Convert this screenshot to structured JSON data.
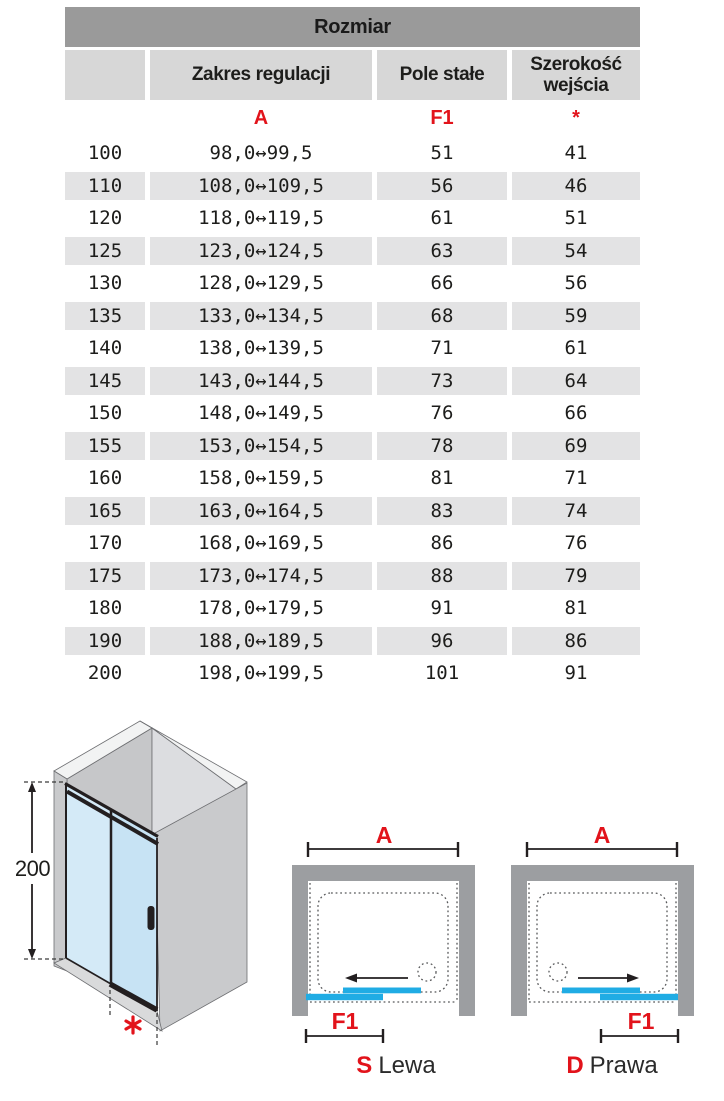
{
  "table": {
    "title": "Rozmiar",
    "columns": [
      "",
      "Zakres regulacji",
      "Pole stałe",
      "Szerokość wejścia"
    ],
    "symbols": [
      "",
      "A",
      "F1",
      "*"
    ],
    "rows": [
      {
        "size": "100",
        "range": "98,0↔99,5",
        "fixed": "51",
        "entry": "41"
      },
      {
        "size": "110",
        "range": "108,0↔109,5",
        "fixed": "56",
        "entry": "46"
      },
      {
        "size": "120",
        "range": "118,0↔119,5",
        "fixed": "61",
        "entry": "51"
      },
      {
        "size": "125",
        "range": "123,0↔124,5",
        "fixed": "63",
        "entry": "54"
      },
      {
        "size": "130",
        "range": "128,0↔129,5",
        "fixed": "66",
        "entry": "56"
      },
      {
        "size": "135",
        "range": "133,0↔134,5",
        "fixed": "68",
        "entry": "59"
      },
      {
        "size": "140",
        "range": "138,0↔139,5",
        "fixed": "71",
        "entry": "61"
      },
      {
        "size": "145",
        "range": "143,0↔144,5",
        "fixed": "73",
        "entry": "64"
      },
      {
        "size": "150",
        "range": "148,0↔149,5",
        "fixed": "76",
        "entry": "66"
      },
      {
        "size": "155",
        "range": "153,0↔154,5",
        "fixed": "78",
        "entry": "69"
      },
      {
        "size": "160",
        "range": "158,0↔159,5",
        "fixed": "81",
        "entry": "71"
      },
      {
        "size": "165",
        "range": "163,0↔164,5",
        "fixed": "83",
        "entry": "74"
      },
      {
        "size": "170",
        "range": "168,0↔169,5",
        "fixed": "86",
        "entry": "76"
      },
      {
        "size": "175",
        "range": "173,0↔174,5",
        "fixed": "88",
        "entry": "79"
      },
      {
        "size": "180",
        "range": "178,0↔179,5",
        "fixed": "91",
        "entry": "81"
      },
      {
        "size": "190",
        "range": "188,0↔189,5",
        "fixed": "96",
        "entry": "86"
      },
      {
        "size": "200",
        "range": "198,0↔199,5",
        "fixed": "101",
        "entry": "91"
      }
    ]
  },
  "diagram3d": {
    "height_label": "200",
    "footnote_symbol": "*"
  },
  "diagram_left": {
    "width_label": "A",
    "fixed_label": "F1",
    "side_letter": "S",
    "side_name": "Lewa"
  },
  "diagram_right": {
    "width_label": "A",
    "fixed_label": "F1",
    "side_letter": "D",
    "side_name": "Prawa"
  },
  "colors": {
    "accent_red": "#e2131b",
    "accent_cyan": "#20ace4",
    "wall_gray": "#9c9ea1",
    "header_bar_gray": "#9a9a9a",
    "header_cell_gray": "#d7d7d7",
    "row_alt_gray": "#e3e3e4"
  }
}
